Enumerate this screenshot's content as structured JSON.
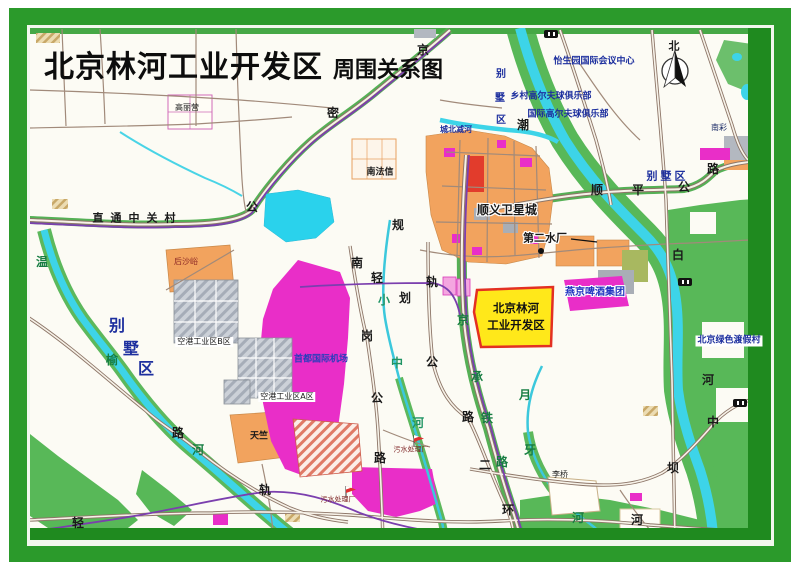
{
  "title": {
    "main": "北京林河工业开发区",
    "sub": "周围关系图"
  },
  "highlight_zone": {
    "line1": "北京林河",
    "line2": "工业开发区",
    "fill": "#ffe81a",
    "border": "#e33022"
  },
  "north": {
    "label": "北"
  },
  "palette": {
    "frame_green": "#2b9a2b",
    "inner_band_green": "#1f8a1f",
    "map_bg": "#fcfbf4",
    "water_cyan": "#3dd4e8",
    "park_green": "#58b858",
    "urban_orange": "#f2a35e",
    "airport_magenta": "#e92ec8",
    "road_brown": "#8d7668",
    "railway_purple": "#7b3fae",
    "label_blue": "#1d2f9e",
    "label_green": "#177d42",
    "label_black": "#1a1a1a",
    "label_darkred": "#7c2222",
    "highlight_yellow": "#ffe81a"
  },
  "map_labels": [
    {
      "t": "怡生园国际会议中心",
      "x": 594,
      "y": 62,
      "c": "#1d2f9e",
      "s": 9,
      "b": true,
      "n": "poi-yishengyuan-conference-center"
    },
    {
      "t": "乡村高尔夫球俱乐部",
      "x": 551,
      "y": 97,
      "c": "#1d2f9e",
      "s": 9,
      "b": true,
      "n": "poi-country-golf-club"
    },
    {
      "t": "国际高尔夫球俱乐部",
      "x": 568,
      "y": 115,
      "c": "#1d2f9e",
      "s": 9,
      "b": true,
      "n": "poi-international-golf-club"
    },
    {
      "t": "北京绿色渡假村",
      "x": 729,
      "y": 341,
      "c": "#1d2f9e",
      "s": 9,
      "b": true,
      "bg": "#ffffff",
      "n": "poi-beijing-green-resort"
    },
    {
      "t": "首都国际机场",
      "x": 321,
      "y": 360,
      "c": "#2a3dbb",
      "s": 9,
      "b": true,
      "n": "poi-capital-international-airport"
    },
    {
      "t": "燕京啤酒集团",
      "x": 595,
      "y": 293,
      "c": "#2336c0",
      "s": 10,
      "b": true,
      "halo": true,
      "n": "poi-yanjing-beer-group"
    },
    {
      "t": "南彩",
      "x": 719,
      "y": 128,
      "c": "#1a2a66",
      "s": 8,
      "n": "town-nancai"
    },
    {
      "t": "别墅区",
      "x": 666,
      "y": 176,
      "c": "#1d2f9e",
      "s": 11,
      "b": true,
      "ls": 3,
      "n": "villa-area-east"
    },
    {
      "t": "别",
      "x": 501,
      "y": 75,
      "c": "#1d2f9e",
      "s": 10,
      "b": true,
      "n": "villa-area-north-char"
    },
    {
      "t": "墅",
      "x": 500,
      "y": 99,
      "c": "#1d2f9e",
      "s": 10,
      "b": true,
      "n": "villa-area-north-char"
    },
    {
      "t": "区",
      "x": 501,
      "y": 121,
      "c": "#1d2f9e",
      "s": 10,
      "b": true,
      "n": "villa-area-north-char"
    },
    {
      "t": "别",
      "x": 117,
      "y": 326,
      "c": "#1d2f9e",
      "s": 16,
      "b": true,
      "n": "villa-area-west-char"
    },
    {
      "t": "墅",
      "x": 131,
      "y": 349,
      "c": "#1d2f9e",
      "s": 16,
      "b": true,
      "n": "villa-area-west-char"
    },
    {
      "t": "区",
      "x": 146,
      "y": 369,
      "c": "#1d2f9e",
      "s": 16,
      "b": true,
      "n": "villa-area-west-char"
    },
    {
      "t": "城北减河",
      "x": 456,
      "y": 130,
      "c": "#1d2f9e",
      "s": 8,
      "b": true,
      "n": "river-chengbeijian-label"
    },
    {
      "t": "直通中关村",
      "x": 134,
      "y": 218,
      "s": 11,
      "b": true,
      "ls": 7,
      "n": "road-note-direct-to-zhongguancun"
    },
    {
      "t": "南法信",
      "x": 380,
      "y": 173,
      "s": 9,
      "b": true,
      "n": "town-nanfaxin"
    },
    {
      "t": "顺义卫星城",
      "x": 507,
      "y": 210,
      "s": 12,
      "b": true,
      "halo": true,
      "n": "town-shunyi-satellite-city"
    },
    {
      "t": "第二水厂",
      "x": 545,
      "y": 238,
      "s": 11,
      "b": true,
      "halo": true,
      "n": "poi-no2-waterworks"
    },
    {
      "t": "高丽营",
      "x": 187,
      "y": 108,
      "s": 8,
      "n": "town-gaoliying"
    },
    {
      "t": "后沙峪",
      "x": 186,
      "y": 262,
      "c": "#8a2424",
      "s": 8,
      "n": "town-houshayu"
    },
    {
      "t": "空港工业区B区",
      "x": 204,
      "y": 342,
      "s": 8,
      "bg": "#ffffff",
      "n": "zone-airport-industrial-b"
    },
    {
      "t": "空港工业区A区",
      "x": 287,
      "y": 397,
      "s": 8,
      "bg": "#ffffff",
      "n": "zone-airport-industrial-a"
    },
    {
      "t": "天竺",
      "x": 259,
      "y": 437,
      "s": 9,
      "b": true,
      "n": "town-tianzhu"
    },
    {
      "t": "李桥",
      "x": 560,
      "y": 475,
      "s": 8,
      "n": "town-liqiao"
    },
    {
      "t": "污水处理厂",
      "x": 411,
      "y": 450,
      "c": "#7c2222",
      "s": 7,
      "n": "poi-sewage-plant-1"
    },
    {
      "t": "污水处理厂",
      "x": 338,
      "y": 500,
      "c": "#7c2222",
      "s": 7,
      "n": "poi-sewage-plant-2"
    },
    {
      "t": "京",
      "x": 423,
      "y": 50,
      "s": 12,
      "b": true,
      "n": "road-char-jingmi"
    },
    {
      "t": "密",
      "x": 333,
      "y": 113,
      "s": 12,
      "b": true,
      "n": "road-char-jingmi"
    },
    {
      "t": "公",
      "x": 252,
      "y": 207,
      "s": 12,
      "b": true,
      "n": "road-char-jingmi"
    },
    {
      "t": "顺",
      "x": 597,
      "y": 190,
      "s": 12,
      "b": true,
      "n": "road-char-shunping"
    },
    {
      "t": "平",
      "x": 638,
      "y": 190,
      "s": 12,
      "b": true,
      "n": "road-char-shunping"
    },
    {
      "t": "公",
      "x": 684,
      "y": 187,
      "s": 12,
      "b": true,
      "n": "road-char-shunping"
    },
    {
      "t": "路",
      "x": 713,
      "y": 169,
      "s": 12,
      "b": true,
      "n": "road-char-shunping"
    },
    {
      "t": "规",
      "x": 398,
      "y": 225,
      "s": 12,
      "b": true,
      "n": "rail-char-planned"
    },
    {
      "t": "划",
      "x": 405,
      "y": 298,
      "s": 12,
      "b": true,
      "n": "rail-char-planned"
    },
    {
      "t": "轻",
      "x": 377,
      "y": 278,
      "s": 12,
      "b": true,
      "n": "rail-char-lightrail"
    },
    {
      "t": "轨",
      "x": 432,
      "y": 282,
      "s": 12,
      "b": true,
      "n": "rail-char-lightrail"
    },
    {
      "t": "南",
      "x": 357,
      "y": 263,
      "s": 12,
      "b": true,
      "n": "road-char-nangang"
    },
    {
      "t": "岗",
      "x": 367,
      "y": 336,
      "s": 12,
      "b": true,
      "n": "road-char-nangang"
    },
    {
      "t": "公",
      "x": 377,
      "y": 398,
      "s": 12,
      "b": true,
      "n": "road-char-nangang"
    },
    {
      "t": "路",
      "x": 380,
      "y": 458,
      "s": 12,
      "b": true,
      "n": "road-char-nangang"
    },
    {
      "t": "路",
      "x": 178,
      "y": 433,
      "s": 12,
      "b": true,
      "n": "road-char-west"
    },
    {
      "t": "公",
      "x": 432,
      "y": 362,
      "s": 12,
      "b": true,
      "n": "road-char-jingcheng-hwy"
    },
    {
      "t": "路",
      "x": 468,
      "y": 417,
      "s": 12,
      "b": true,
      "n": "road-char-jingcheng-hwy"
    },
    {
      "t": "二",
      "x": 485,
      "y": 465,
      "s": 12,
      "b": true,
      "n": "road-char-erhuan"
    },
    {
      "t": "环",
      "x": 508,
      "y": 510,
      "s": 12,
      "b": true,
      "n": "road-char-erhuan"
    },
    {
      "t": "轨",
      "x": 265,
      "y": 490,
      "s": 12,
      "b": true,
      "n": "rail-char-lightrail-south"
    },
    {
      "t": "轻",
      "x": 78,
      "y": 523,
      "s": 12,
      "b": true,
      "n": "rail-char-lightrail-south"
    },
    {
      "t": "中",
      "x": 713,
      "y": 422,
      "s": 12,
      "b": true,
      "n": "road-char-zhongba"
    },
    {
      "t": "坝",
      "x": 673,
      "y": 468,
      "s": 12,
      "b": true,
      "n": "road-char-zhongba"
    },
    {
      "t": "河",
      "x": 637,
      "y": 520,
      "s": 12,
      "b": true,
      "n": "road-char-zhongba"
    },
    {
      "t": "潮",
      "x": 523,
      "y": 125,
      "s": 12,
      "b": true,
      "n": "river-char-chaobai"
    },
    {
      "t": "白",
      "x": 678,
      "y": 255,
      "s": 12,
      "b": true,
      "n": "river-char-chaobai"
    },
    {
      "t": "河",
      "x": 708,
      "y": 380,
      "s": 12,
      "b": true,
      "n": "river-char-chaobai"
    },
    {
      "t": "温",
      "x": 42,
      "y": 262,
      "c": "#177d42",
      "s": 12,
      "b": true,
      "n": "river-char-wenyu"
    },
    {
      "t": "榆",
      "x": 112,
      "y": 360,
      "c": "#177d42",
      "s": 12,
      "b": true,
      "n": "river-char-wenyu"
    },
    {
      "t": "河",
      "x": 198,
      "y": 450,
      "c": "#177d42",
      "s": 12,
      "b": true,
      "n": "river-char-wenyu"
    },
    {
      "t": "小",
      "x": 384,
      "y": 300,
      "c": "#1f9464",
      "s": 12,
      "b": true,
      "n": "river-char-xiaozhong"
    },
    {
      "t": "中",
      "x": 397,
      "y": 363,
      "c": "#1f9464",
      "s": 12,
      "b": true,
      "n": "river-char-xiaozhong"
    },
    {
      "t": "河",
      "x": 418,
      "y": 423,
      "c": "#1f9464",
      "s": 12,
      "b": true,
      "n": "river-char-xiaozhong"
    },
    {
      "t": "京",
      "x": 463,
      "y": 320,
      "c": "#177d42",
      "s": 12,
      "b": true,
      "n": "rail-char-jingcheng-railway"
    },
    {
      "t": "承",
      "x": 477,
      "y": 377,
      "c": "#177d42",
      "s": 12,
      "b": true,
      "n": "rail-char-jingcheng-railway"
    },
    {
      "t": "铁",
      "x": 487,
      "y": 418,
      "c": "#177d42",
      "s": 12,
      "b": true,
      "n": "rail-char-jingcheng-railway"
    },
    {
      "t": "路",
      "x": 502,
      "y": 462,
      "c": "#177d42",
      "s": 12,
      "b": true,
      "n": "rail-char-jingcheng-railway"
    },
    {
      "t": "月",
      "x": 525,
      "y": 395,
      "c": "#177d42",
      "s": 12,
      "b": true,
      "n": "river-char-yueya"
    },
    {
      "t": "牙",
      "x": 530,
      "y": 450,
      "c": "#177d42",
      "s": 12,
      "b": true,
      "n": "river-char-yueya"
    },
    {
      "t": "河",
      "x": 578,
      "y": 518,
      "c": "#177d42",
      "s": 12,
      "b": true,
      "n": "river-char-yueya"
    },
    {
      "t": "北",
      "x": 674,
      "y": 46,
      "s": 11,
      "b": true,
      "n": "north-label"
    }
  ]
}
